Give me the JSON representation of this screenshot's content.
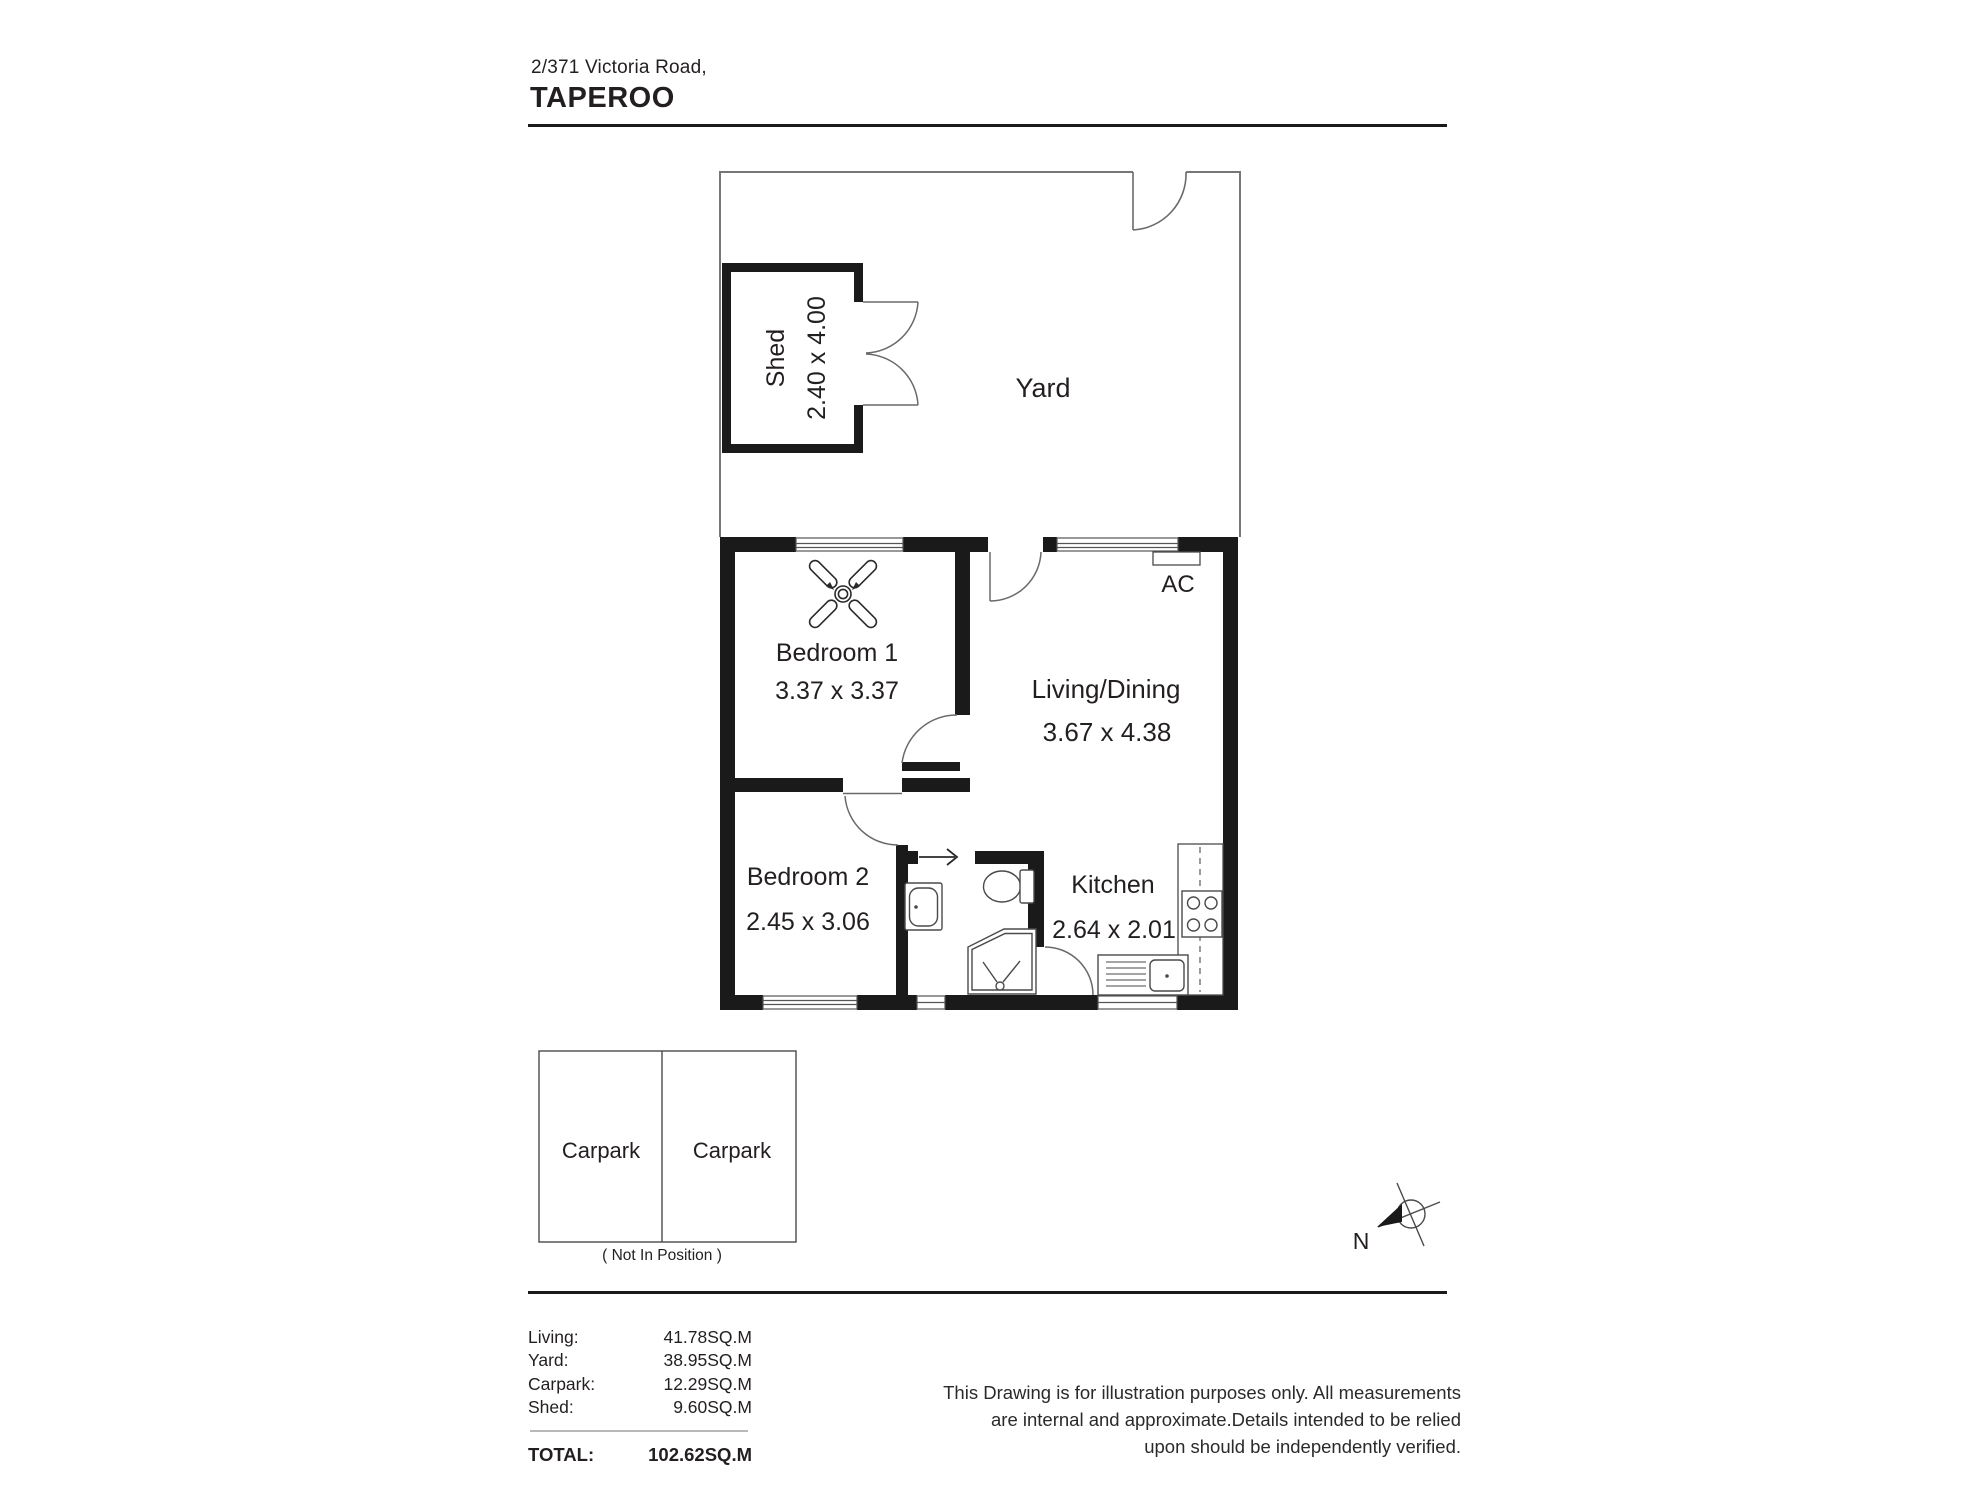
{
  "header": {
    "address_line": "2/371 Victoria Road,",
    "suburb": "TAPEROO"
  },
  "plan": {
    "rooms": {
      "shed": {
        "name": "Shed",
        "dims": "2.40 x 4.00"
      },
      "yard": {
        "name": "Yard"
      },
      "bedroom1": {
        "name": "Bedroom 1",
        "dims": "3.37 x 3.37"
      },
      "living": {
        "name": "Living/Dining",
        "dims": "3.67 x 4.38"
      },
      "bedroom2": {
        "name": "Bedroom 2",
        "dims": "2.45 x 3.06"
      },
      "kitchen": {
        "name": "Kitchen",
        "dims": "2.64 x 2.01"
      },
      "ac_label": "AC"
    },
    "carpark": {
      "left_label": "Carpark",
      "right_label": "Carpark",
      "note": "( Not In Position )"
    },
    "compass": {
      "north_label": "N"
    }
  },
  "areas": {
    "rows": [
      {
        "label": "Living:",
        "value": "41.78SQ.M"
      },
      {
        "label": "Yard:",
        "value": "38.95SQ.M"
      },
      {
        "label": "Carpark:",
        "value": "12.29SQ.M"
      },
      {
        "label": "Shed:",
        "value": "9.60SQ.M"
      }
    ],
    "total_label": "TOTAL:",
    "total_value": "102.62SQ.M"
  },
  "disclaimer": {
    "lines": [
      "This Drawing is for illustration purposes only. All measurements",
      "are internal and approximate.Details intended to be relied",
      "upon should be independently verified."
    ]
  },
  "colors": {
    "wall": "#1a1a1a",
    "thin_line": "#777777",
    "fixture_line": "#4a4a4a",
    "text": "#231f20"
  }
}
